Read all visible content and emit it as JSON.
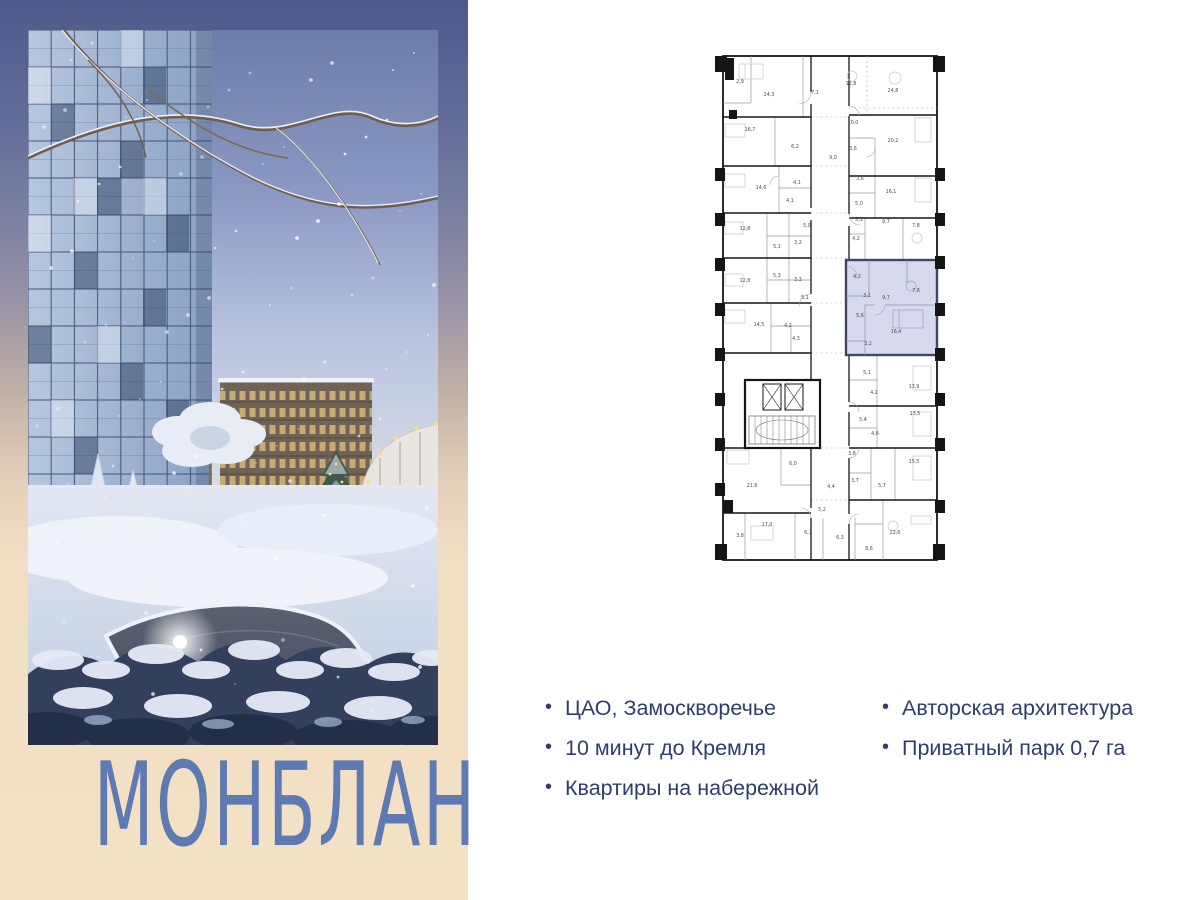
{
  "brand": {
    "wordmark": "МОНБЛАН"
  },
  "features": {
    "bullet": "•",
    "col1": [
      {
        "text": "ЦАО, Замоскворечье"
      },
      {
        "text": "10 минут до Кремля"
      },
      {
        "text": "Квартиры на набережной"
      }
    ],
    "col2": [
      {
        "text": "Авторская архитектура"
      },
      {
        "text": "Приватный парк 0,7 га"
      }
    ]
  },
  "floorplan": {
    "highlight_fill": "#d6daec",
    "highlight_stroke": "#3d4868",
    "label_color": "#4a4a50",
    "highlight_label_color": "#40485f",
    "room_labels": [
      {
        "x": 25,
        "y": 35,
        "v": "2,9"
      },
      {
        "x": 54,
        "y": 48,
        "v": "24,3"
      },
      {
        "x": 100,
        "y": 46,
        "v": "7,1"
      },
      {
        "x": 136,
        "y": 37,
        "v": "12,8"
      },
      {
        "x": 178,
        "y": 44,
        "v": "24,8"
      },
      {
        "x": 35,
        "y": 83,
        "v": "16,7"
      },
      {
        "x": 80,
        "y": 100,
        "v": "6,2"
      },
      {
        "x": 138,
        "y": 76,
        "v": "10,0"
      },
      {
        "x": 118,
        "y": 111,
        "v": "9,0"
      },
      {
        "x": 138,
        "y": 102,
        "v": "3,6"
      },
      {
        "x": 178,
        "y": 94,
        "v": "20,2"
      },
      {
        "x": 46,
        "y": 141,
        "v": "14,6"
      },
      {
        "x": 82,
        "y": 136,
        "v": "4,1"
      },
      {
        "x": 75,
        "y": 154,
        "v": "4,1"
      },
      {
        "x": 145,
        "y": 132,
        "v": "3,6"
      },
      {
        "x": 144,
        "y": 157,
        "v": "5,0"
      },
      {
        "x": 176,
        "y": 145,
        "v": "16,1"
      },
      {
        "x": 30,
        "y": 182,
        "v": "12,8"
      },
      {
        "x": 92,
        "y": 179,
        "v": "5,0"
      },
      {
        "x": 144,
        "y": 173,
        "v": "5,1"
      },
      {
        "x": 171,
        "y": 175,
        "v": "9,7"
      },
      {
        "x": 201,
        "y": 179,
        "v": "7,8"
      },
      {
        "x": 62,
        "y": 200,
        "v": "5,1"
      },
      {
        "x": 83,
        "y": 196,
        "v": "3,2"
      },
      {
        "x": 141,
        "y": 192,
        "v": "4,2"
      },
      {
        "x": 30,
        "y": 234,
        "v": "12,8"
      },
      {
        "x": 62,
        "y": 229,
        "v": "5,3"
      },
      {
        "x": 83,
        "y": 233,
        "v": "3,3"
      },
      {
        "x": 90,
        "y": 251,
        "v": "5,1"
      },
      {
        "x": 142,
        "y": 230,
        "v": "4,2",
        "hl": true
      },
      {
        "x": 152,
        "y": 249,
        "v": "3,1",
        "hl": true
      },
      {
        "x": 171,
        "y": 251,
        "v": "9,7",
        "hl": true
      },
      {
        "x": 201,
        "y": 244,
        "v": "7,8",
        "hl": true
      },
      {
        "x": 44,
        "y": 278,
        "v": "14,5"
      },
      {
        "x": 73,
        "y": 279,
        "v": "4,2"
      },
      {
        "x": 81,
        "y": 292,
        "v": "4,3"
      },
      {
        "x": 145,
        "y": 269,
        "v": "5,6",
        "hl": true
      },
      {
        "x": 181,
        "y": 285,
        "v": "16,4",
        "hl": true
      },
      {
        "x": 153,
        "y": 297,
        "v": "3,2",
        "hl": true
      },
      {
        "x": 152,
        "y": 326,
        "v": "5,1"
      },
      {
        "x": 199,
        "y": 340,
        "v": "13,9"
      },
      {
        "x": 159,
        "y": 346,
        "v": "4,2"
      },
      {
        "x": 148,
        "y": 373,
        "v": "5,4"
      },
      {
        "x": 200,
        "y": 367,
        "v": "13,5"
      },
      {
        "x": 160,
        "y": 387,
        "v": "4,6"
      },
      {
        "x": 137,
        "y": 407,
        "v": "3,8"
      },
      {
        "x": 199,
        "y": 415,
        "v": "15,5"
      },
      {
        "x": 78,
        "y": 417,
        "v": "6,0"
      },
      {
        "x": 37,
        "y": 439,
        "v": "21,8"
      },
      {
        "x": 116,
        "y": 440,
        "v": "4,4"
      },
      {
        "x": 140,
        "y": 434,
        "v": "3,7"
      },
      {
        "x": 167,
        "y": 439,
        "v": "5,7"
      },
      {
        "x": 107,
        "y": 463,
        "v": "5,2"
      },
      {
        "x": 52,
        "y": 478,
        "v": "17,0"
      },
      {
        "x": 25,
        "y": 489,
        "v": "3,8"
      },
      {
        "x": 93,
        "y": 486,
        "v": "6,7"
      },
      {
        "x": 125,
        "y": 491,
        "v": "6,3"
      },
      {
        "x": 180,
        "y": 486,
        "v": "22,6"
      },
      {
        "x": 154,
        "y": 502,
        "v": "8,6"
      }
    ]
  },
  "palette": {
    "panel_top": "#4d5a8b",
    "panel_bottom": "#f4e1c4",
    "wordmark": "#5d7ab2",
    "features_text": "#2e3e68",
    "plan_walls": "#161616"
  }
}
